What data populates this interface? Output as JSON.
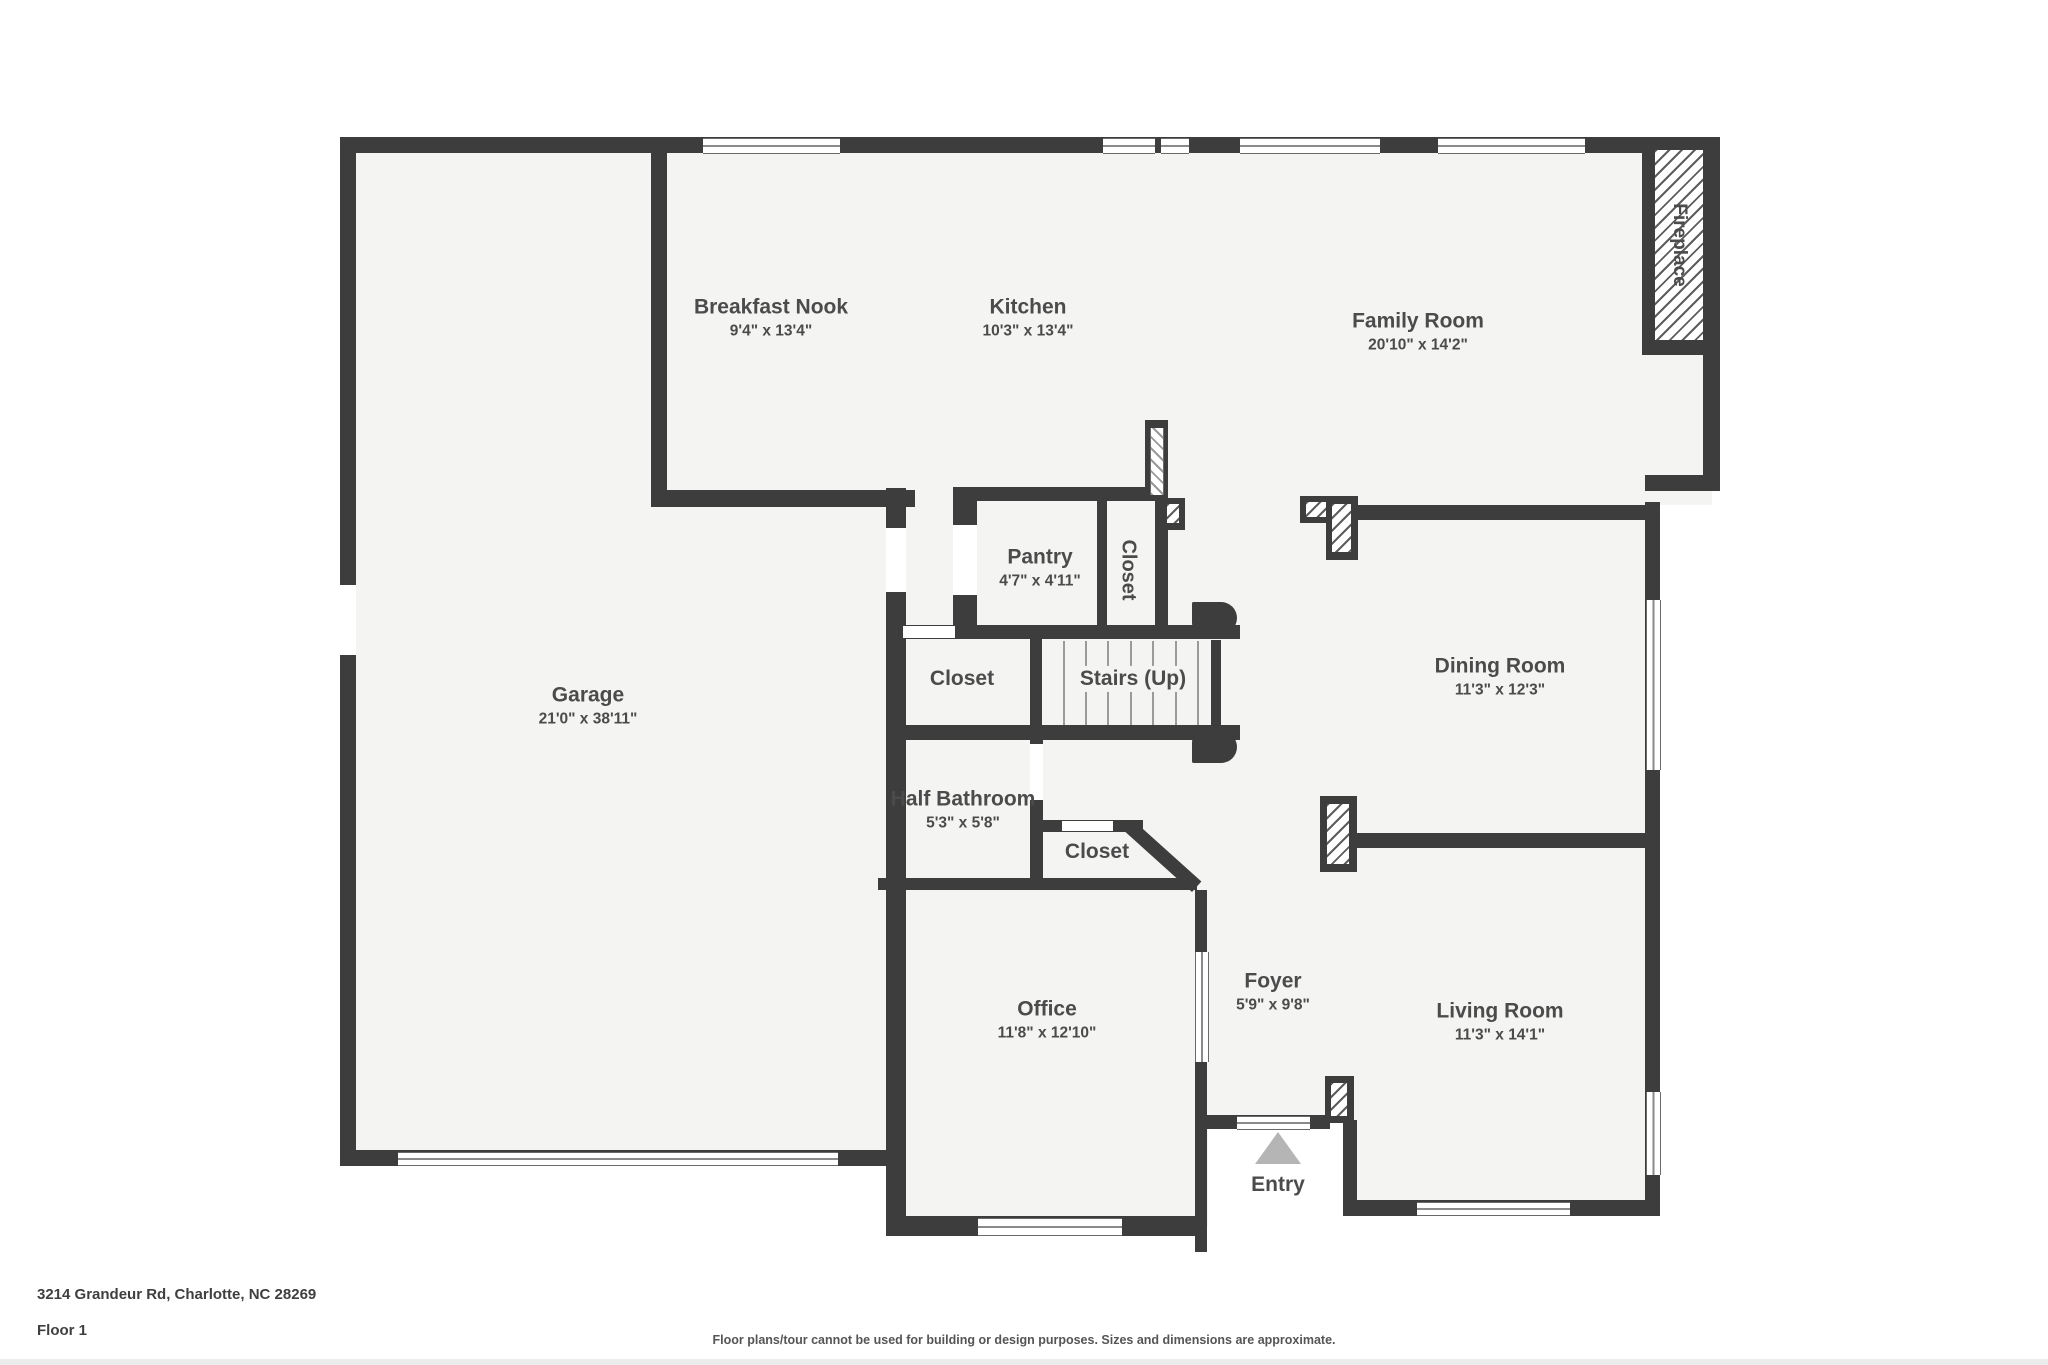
{
  "rooms": {
    "breakfast_nook": {
      "name": "Breakfast Nook",
      "dims": "9'4\" x 13'4\""
    },
    "kitchen": {
      "name": "Kitchen",
      "dims": "10'3\" x 13'4\""
    },
    "family_room": {
      "name": "Family Room",
      "dims": "20'10\" x 14'2\""
    },
    "garage": {
      "name": "Garage",
      "dims": "21'0\" x 38'11\""
    },
    "pantry": {
      "name": "Pantry",
      "dims": "4'7\" x 4'11\""
    },
    "closet_kitchen": {
      "name": "Closet"
    },
    "closet_hall": {
      "name": "Closet"
    },
    "stairs": {
      "name": "Stairs (Up)"
    },
    "dining_room": {
      "name": "Dining Room",
      "dims": "11'3\" x 12'3\""
    },
    "half_bathroom": {
      "name": "Half Bathroom",
      "dims": "5'3\" x 5'8\""
    },
    "closet_foyer": {
      "name": "Closet"
    },
    "office": {
      "name": "Office",
      "dims": "11'8\" x 12'10\""
    },
    "foyer": {
      "name": "Foyer",
      "dims": "5'9\" x 9'8\""
    },
    "living_room": {
      "name": "Living Room",
      "dims": "11'3\" x 14'1\""
    },
    "entry": {
      "name": "Entry"
    },
    "fireplace": {
      "name": "Fireplace"
    }
  },
  "footer": {
    "address": "3214 Grandeur Rd, Charlotte, NC 28269",
    "floor": "Floor 1",
    "disclaimer": "Floor plans/tour cannot be used for building or design purposes. Sizes and dimensions are approximate."
  },
  "colors": {
    "wall": "#3d3d3d",
    "floor": "#f4f4f3",
    "background": "#ffffff",
    "text": "#4b4b4b",
    "entry_arrow": "#b5b5b5"
  }
}
